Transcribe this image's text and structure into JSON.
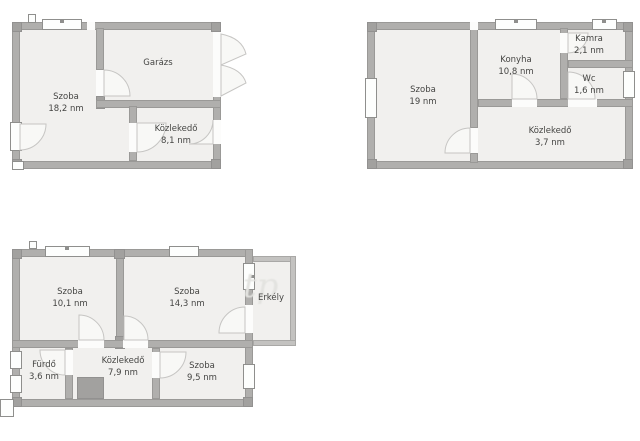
{
  "colors": {
    "wall": "#b0afad",
    "wall_dark": "#a2a19f",
    "balcony_wall": "#c3c2c0",
    "floor": "#f1f0ee",
    "window": "#fdfefd",
    "background": "#ffffff",
    "text": "#454543"
  },
  "plans": [
    {
      "title": "top-left-floorplan",
      "rooms": [
        {
          "name": "Szoba",
          "area": "18,2 nm"
        },
        {
          "name": "Garázs",
          "area": ""
        },
        {
          "name": "Közlekedő",
          "area": "8,1 nm"
        }
      ]
    },
    {
      "title": "top-right-floorplan",
      "rooms": [
        {
          "name": "Szoba",
          "area": "19 nm"
        },
        {
          "name": "Konyha",
          "area": "10,8 nm"
        },
        {
          "name": "Kamra",
          "area": "2,1 nm"
        },
        {
          "name": "Wc",
          "area": "1,6 nm"
        },
        {
          "name": "Közlekedő",
          "area": "3,7 nm"
        }
      ]
    },
    {
      "title": "bottom-left-floorplan",
      "rooms": [
        {
          "name": "Szoba",
          "area": "10,1 nm"
        },
        {
          "name": "Szoba",
          "area": "14,3 nm"
        },
        {
          "name": "Erkély",
          "area": ""
        },
        {
          "name": "Fürdő",
          "area": "3,6 nm"
        },
        {
          "name": "Közlekedő",
          "area": "7,9 nm"
        },
        {
          "name": "Szoba",
          "area": "9,5 nm"
        }
      ]
    }
  ],
  "watermark": {
    "text": "tp"
  }
}
